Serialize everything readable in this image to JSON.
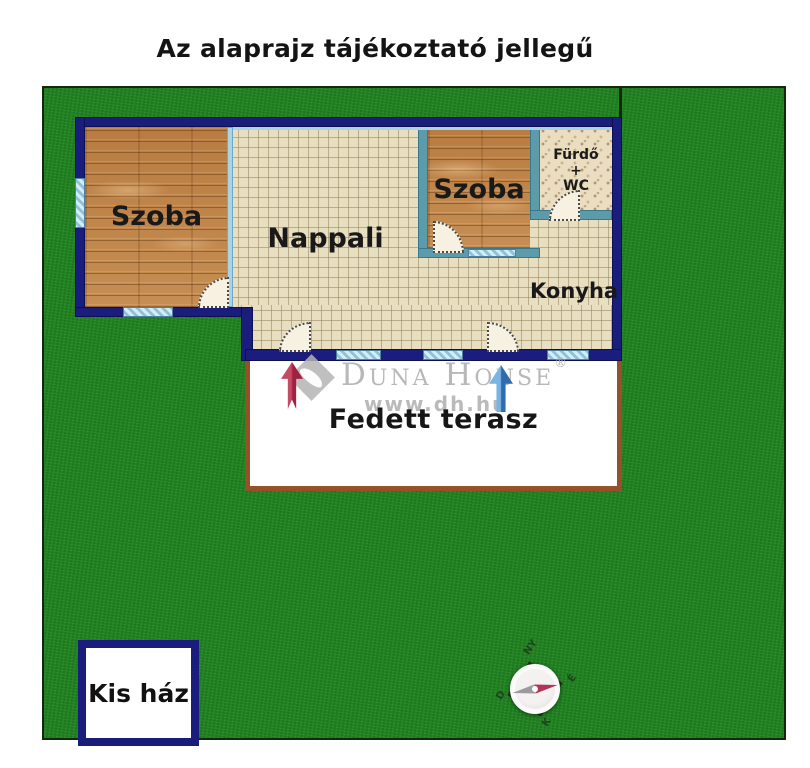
{
  "title": "Az alaprajz tájékoztató jellegű",
  "plan": {
    "rooms": {
      "szoba1": "Szoba",
      "szoba2": "Szoba",
      "nappali": "Nappali",
      "konyha": "Konyha",
      "furdo": {
        "line1": "Fürdő",
        "line2": "+",
        "line3": "WC"
      },
      "terasz": "Fedett terasz"
    },
    "outbuilding": "Kis ház"
  },
  "watermark": {
    "brand": "Duna House",
    "registered": "®",
    "url": "www.dh.hu"
  },
  "compass": {
    "north": "É",
    "south": "D",
    "east": "K",
    "west": "NY"
  },
  "colors": {
    "wall_navy": "#1b1d7c",
    "grass_green": "#218321",
    "wood_brown": "#c08a50",
    "tile_beige": "#e8dec0",
    "terrace_border_brown": "#96502a",
    "window_blue": "#a9d3e6",
    "red_arrow": "#b5304e",
    "blue_arrow": "#2f6cae"
  }
}
